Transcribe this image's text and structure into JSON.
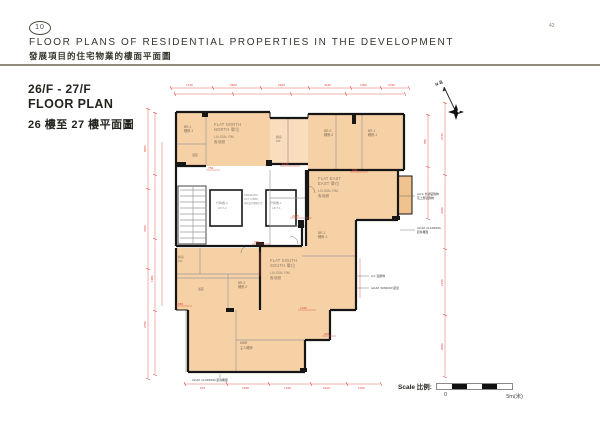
{
  "page": {
    "number": "42"
  },
  "header": {
    "badge": "10",
    "title": "FLOOR PLANS OF RESIDENTIAL PROPERTIES IN THE DEVELOPMENT",
    "subtitle": "發展項目的住宅物業的樓面平面圖"
  },
  "section": {
    "floor_range": "26/F - 27/F",
    "floor_label": "FLOOR PLAN",
    "floor_label_zh": "26 樓至 27 樓平面圖"
  },
  "compass": {
    "label": "N 北"
  },
  "scalebar": {
    "label": "Scale 比例:",
    "start": "0",
    "end": "5m(米)"
  },
  "plan": {
    "flats": {
      "north": {
        "name": "FLAT NORTH",
        "name_zh": "NORTH 單位",
        "room": "LIV./DIN. RM.",
        "room_zh": "客/飯廳"
      },
      "east": {
        "name": "FLAT EAST",
        "name_zh": "EAST 單位",
        "room": "LIV./DIN. RM.",
        "room_zh": "客/飯廳"
      },
      "south": {
        "name": "FLAT SOUTH",
        "name_zh": "SOUTH 單位",
        "room": "LIV./DIN. RM.",
        "room_zh": "客/飯廳"
      }
    },
    "rooms": {
      "br1": "BR-1",
      "br1_zh": "睡房-1",
      "br2": "BR-2",
      "br2_zh": "睡房-2",
      "mbr": "MBR",
      "mbr_zh": "主人睡房",
      "bath_zh": "浴室",
      "kit": "KIT.",
      "kit_zh": "廚房",
      "lift1": "LIFT-1",
      "lift1_zh": "升降機-1",
      "lift2": "LIFT-2",
      "lift2_zh": "升降機-2",
      "lobby1": "FIREMAN'S",
      "lobby2": "LIFT LOBBY",
      "lobby_zh": "消防員升降機大堂"
    },
    "annotations": {
      "a1a": "A.F.F. 外牆裝飾物",
      "a1b": "及上層裝飾物",
      "a2a": "ALUM. CLADDING",
      "a2b": "鋁質覆面",
      "a3": "A.F. 裝飾物",
      "a4": "ALUM. WINDOW 鋁窗",
      "a5": "ALUM. CLADDING 鋁質覆面"
    },
    "dims": {
      "top": [
        "1745",
        "3650",
        "2150",
        "3125",
        "1050",
        "2750"
      ],
      "left": [
        "8250",
        "3150",
        "2750",
        "1950"
      ],
      "right": [
        "2725",
        "3150",
        "2150",
        "850",
        "8250"
      ],
      "bottom": [
        "975",
        "2150",
        "1345",
        "3125",
        "1150"
      ],
      "inner": [
        "750",
        "1125",
        "900",
        "2025",
        "675",
        "865",
        "1345",
        "525"
      ]
    }
  }
}
